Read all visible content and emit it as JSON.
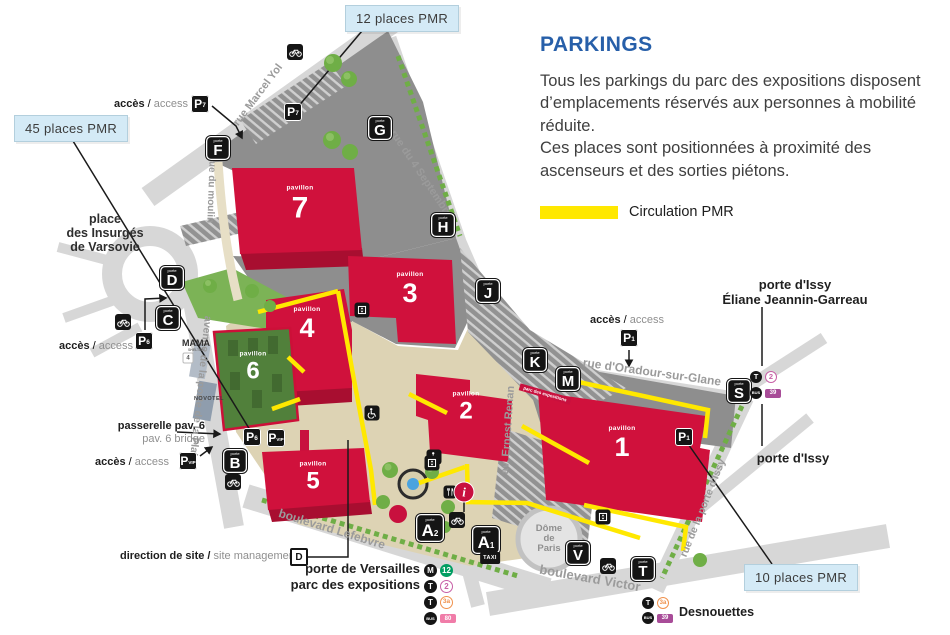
{
  "panel": {
    "title": "PARKINGS",
    "paragraph1": "Tous les parkings du parc des expositions disposent d’emplacements réservés aux personnes à mobilité réduite.",
    "paragraph2": "Ces places sont positionnées à proximité des ascenseurs et des sorties piétons.",
    "legend": {
      "label": "Circulation PMR",
      "color": "#ffe800"
    }
  },
  "callouts": [
    {
      "label": "12 places PMR"
    },
    {
      "label": "45 places PMR"
    },
    {
      "label": "10 places PMR"
    }
  ],
  "access_label": {
    "bold": "accès",
    "separator": " / ",
    "normal": "access"
  },
  "labels": {
    "place_insurges": {
      "line1": "place",
      "line2": "des Insurgés",
      "line3": "de Varsovie"
    },
    "passerelle": {
      "bold": "passerelle pav. 6",
      "normal": "pav. 6 bridge"
    },
    "direction": {
      "bold": "direction de site /",
      "normal": " site management"
    },
    "porte_versailles": {
      "line1": "porte de Versailles",
      "line2": "parc des expositions"
    },
    "porte_issy_eliane": {
      "line1": "porte d'Issy",
      "line2": "Éliane Jeannin-Garreau"
    },
    "porte_issy": "porte d'Issy",
    "desnouettes": "Desnouettes",
    "dome": {
      "line1": "Dôme",
      "line2": "de",
      "line3": "Paris"
    },
    "mama": {
      "line1": "MAMA",
      "line2": "SHELTER",
      "badge": "4"
    },
    "novotel": "NOVOTEL",
    "banner": "parc des expositions",
    "taxi": "TAXI",
    "info": "i"
  },
  "streets": [
    {
      "name": "rue Marcel Yol"
    },
    {
      "name": "rue du moulin"
    },
    {
      "name": "rue du 4 Septembre"
    },
    {
      "name": "rue d'Oradour-sur-Glane"
    },
    {
      "name": "av. Ernest Renan"
    },
    {
      "name": "avenue de la porte de la Plaine"
    },
    {
      "name": "boulevard Lefebvre"
    },
    {
      "name": "boulevard Victor"
    },
    {
      "name": "rue de la porte d'Issy"
    }
  ],
  "pavilions": [
    {
      "word": "pavillon",
      "num": "7"
    },
    {
      "word": "pavillon",
      "num": "3"
    },
    {
      "word": "pavillon",
      "num": "4"
    },
    {
      "word": "pavillon",
      "num": "6"
    },
    {
      "word": "pavillon",
      "num": "2"
    },
    {
      "word": "pavillon",
      "num": "1"
    },
    {
      "word": "pavillon",
      "num": "5"
    }
  ],
  "gates": [
    {
      "small": "porte",
      "letter": "F"
    },
    {
      "small": "porte",
      "letter": "G"
    },
    {
      "small": "porte",
      "letter": "H"
    },
    {
      "small": "porte",
      "letter": "J"
    },
    {
      "small": "porte",
      "letter": "K"
    },
    {
      "small": "porte",
      "letter": "M"
    },
    {
      "small": "porte",
      "letter": "S"
    },
    {
      "small": "porte",
      "letter": "T"
    },
    {
      "small": "porte",
      "letter": "V"
    },
    {
      "small": "porte",
      "letter": "B"
    },
    {
      "small": "porte",
      "letter": "C"
    },
    {
      "small": "porte",
      "letter": "D"
    },
    {
      "small": "porte",
      "letter": "A",
      "sub": "2"
    },
    {
      "small": "porte",
      "letter": "A",
      "sub": "1"
    }
  ],
  "parkings": [
    {
      "letter": "P",
      "sub": "7"
    },
    {
      "letter": "P",
      "sub": "7"
    },
    {
      "letter": "P",
      "sub": "6"
    },
    {
      "letter": "P",
      "sub": "6"
    },
    {
      "letter": "P",
      "sub": "VIP"
    },
    {
      "letter": "P",
      "sub": "VIP"
    },
    {
      "letter": "P",
      "sub": "1"
    },
    {
      "letter": "P",
      "sub": "1"
    }
  ],
  "direction_marker": {
    "letter": "D"
  },
  "transit": {
    "versailles": {
      "rows": [
        {
          "mode": "M",
          "line": "12",
          "line_color": "#009e62",
          "style": "solid"
        },
        {
          "mode": "T",
          "line": "2",
          "line_color": "#c75fa6",
          "style": "outline"
        },
        {
          "mode": "T",
          "line": "3a",
          "line_color": "#f0924d",
          "style": "outline"
        },
        {
          "mode": "BUS",
          "line": "80",
          "line_color": "#f07ca8",
          "style": "rect"
        }
      ]
    },
    "issy": {
      "rows": [
        {
          "mode": "T",
          "line": "2",
          "line_color": "#c75fa6",
          "style": "outline"
        },
        {
          "mode": "BUS",
          "line": "39",
          "line_color": "#a84c98",
          "style": "rect"
        }
      ]
    },
    "desnouettes": {
      "rows": [
        {
          "mode": "T",
          "line": "3a",
          "line_color": "#f0924d",
          "style": "outline"
        },
        {
          "mode": "BUS",
          "line": "39",
          "line_color": "#a84c98",
          "style": "rect"
        }
      ]
    }
  },
  "colors": {
    "accent_blue": "#275fa9",
    "pmr_yellow": "#ffe800",
    "pavilion_red": "#d0113c",
    "pavilion6_green": "#51803b",
    "callout_bg": "#d4eaf6",
    "info_red": "#c8103e",
    "marker_black": "#151515"
  }
}
